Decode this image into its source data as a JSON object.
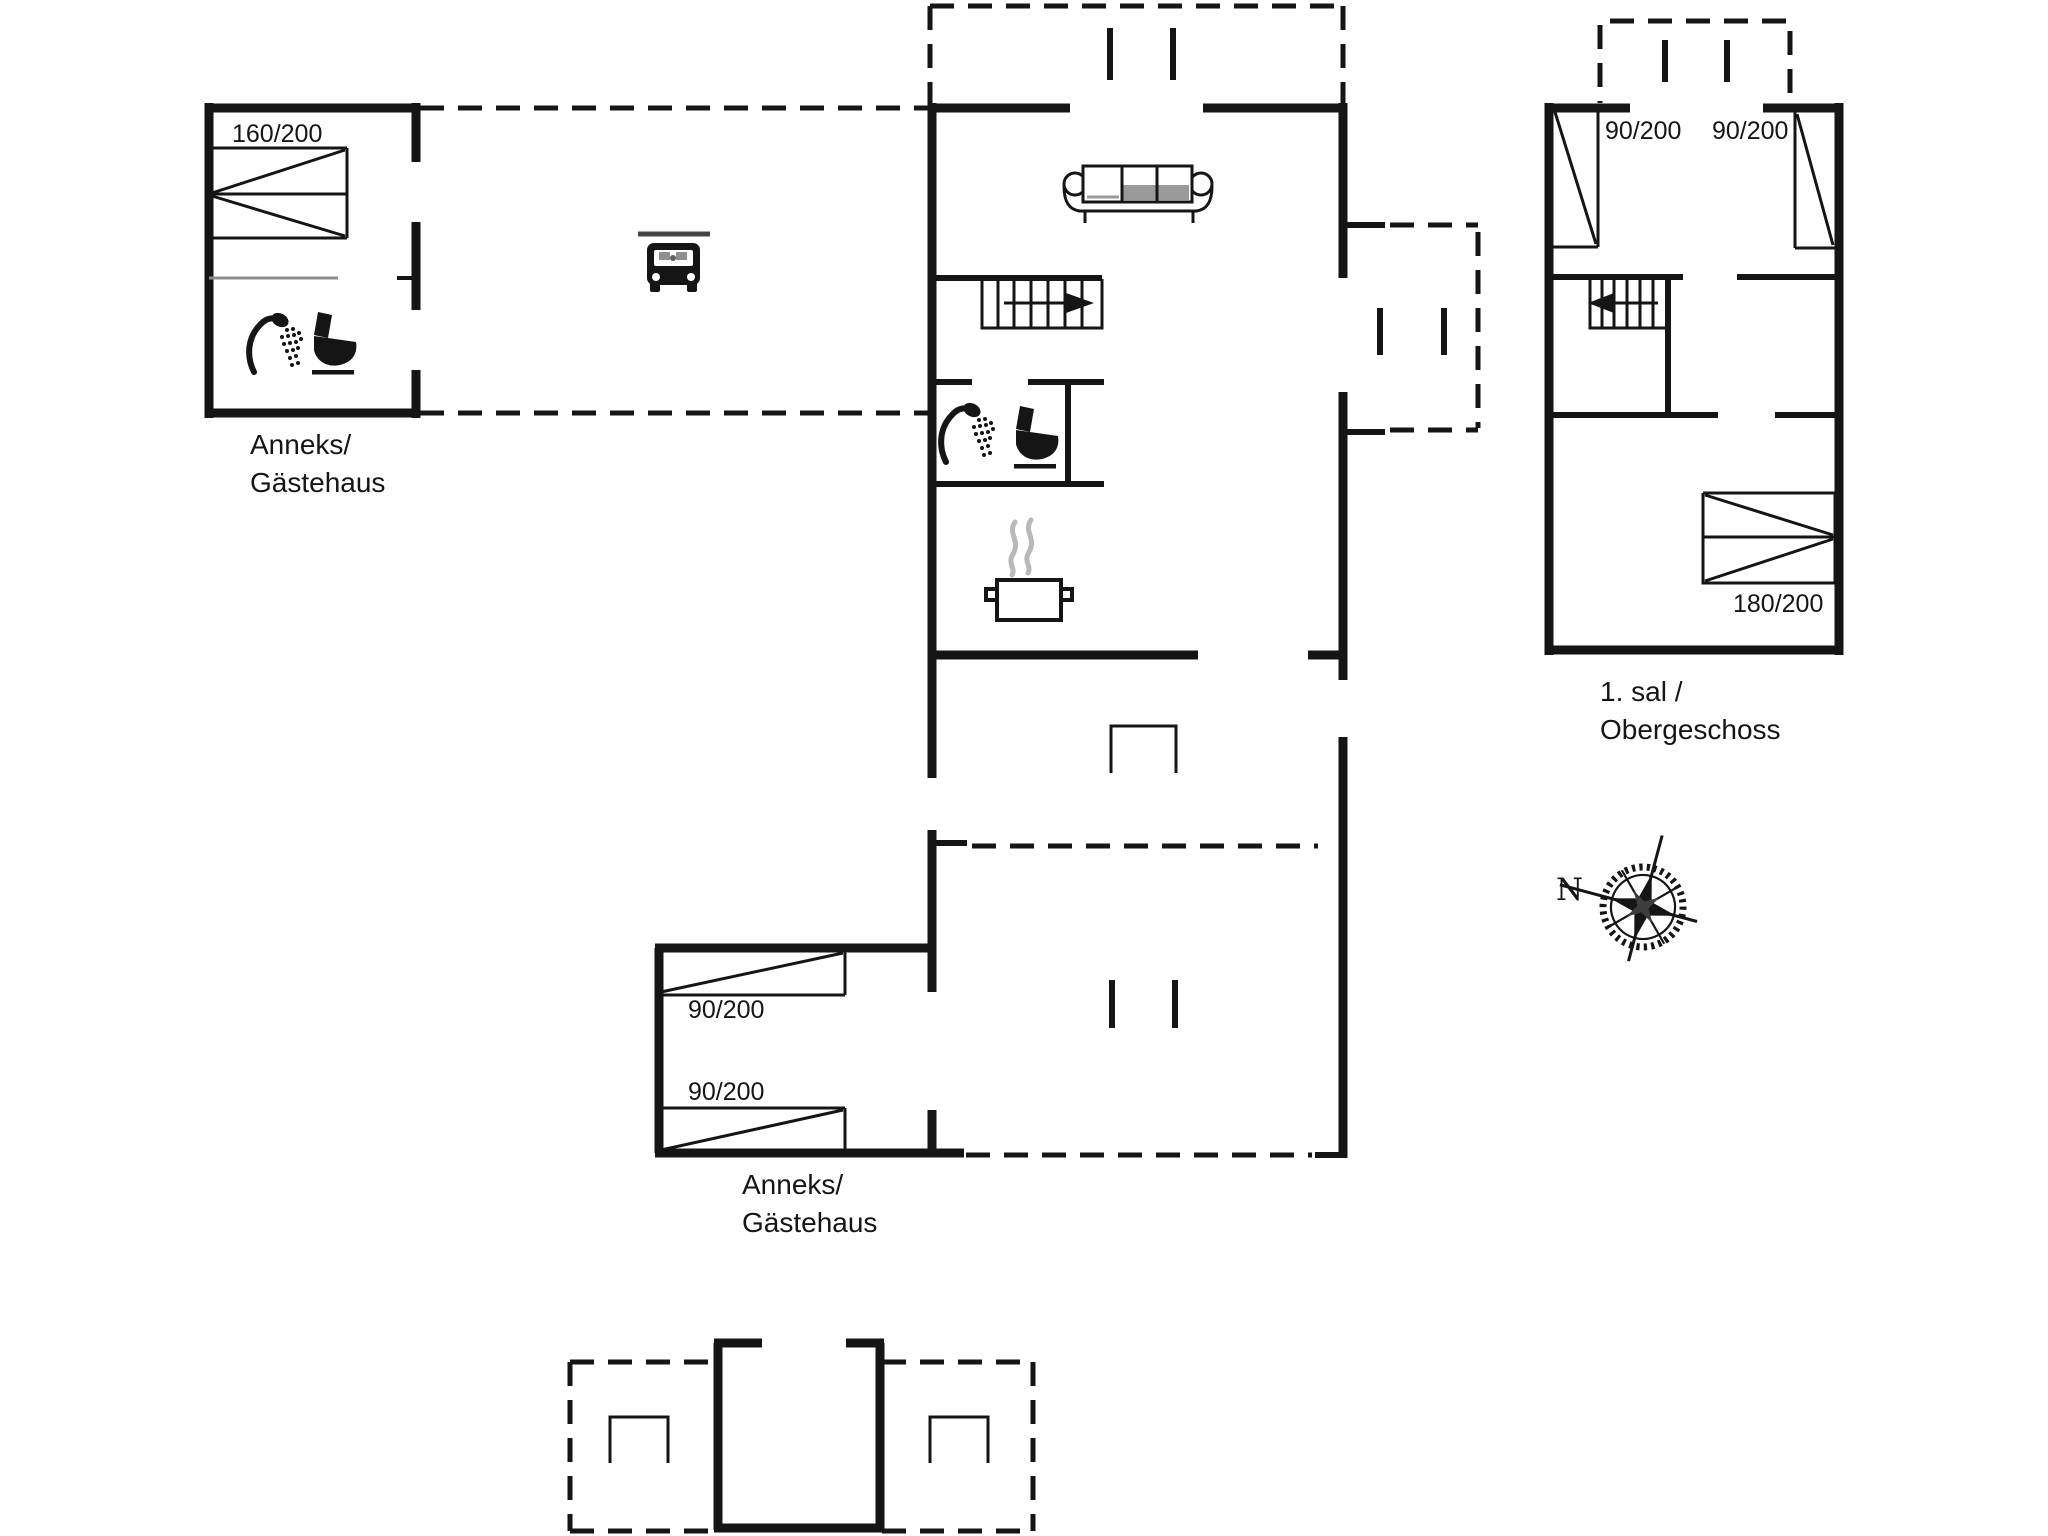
{
  "colors": {
    "ink": "#151515",
    "thin_gray": "#8c8c8c",
    "steam_gray": "#b8b8b8",
    "sofa_gray": "#9a9a9a",
    "background": "#ffffff"
  },
  "plan": {
    "annex_top": {
      "line1": "Anneks/",
      "line2": "Gästehaus",
      "bed": "160/200"
    },
    "upper_floor": {
      "line1": "1. sal /",
      "line2": "Obergeschoss",
      "bed_left": "90/200",
      "bed_right": "90/200",
      "bed_double": "180/200"
    },
    "annex_bottom": {
      "line1": "Anneks/",
      "line2": "Gästehaus",
      "bed_top": "90/200",
      "bed_bottom": "90/200"
    },
    "compass": {
      "north": "N"
    },
    "icons": [
      "double-bed-icon",
      "single-bed-icon",
      "shower-icon",
      "toilet-icon",
      "sofa-icon",
      "stairs-icon",
      "car-icon",
      "carport-roof-line",
      "cooking-pot-icon",
      "door-opening-icon",
      "compass-rose-icon"
    ]
  }
}
